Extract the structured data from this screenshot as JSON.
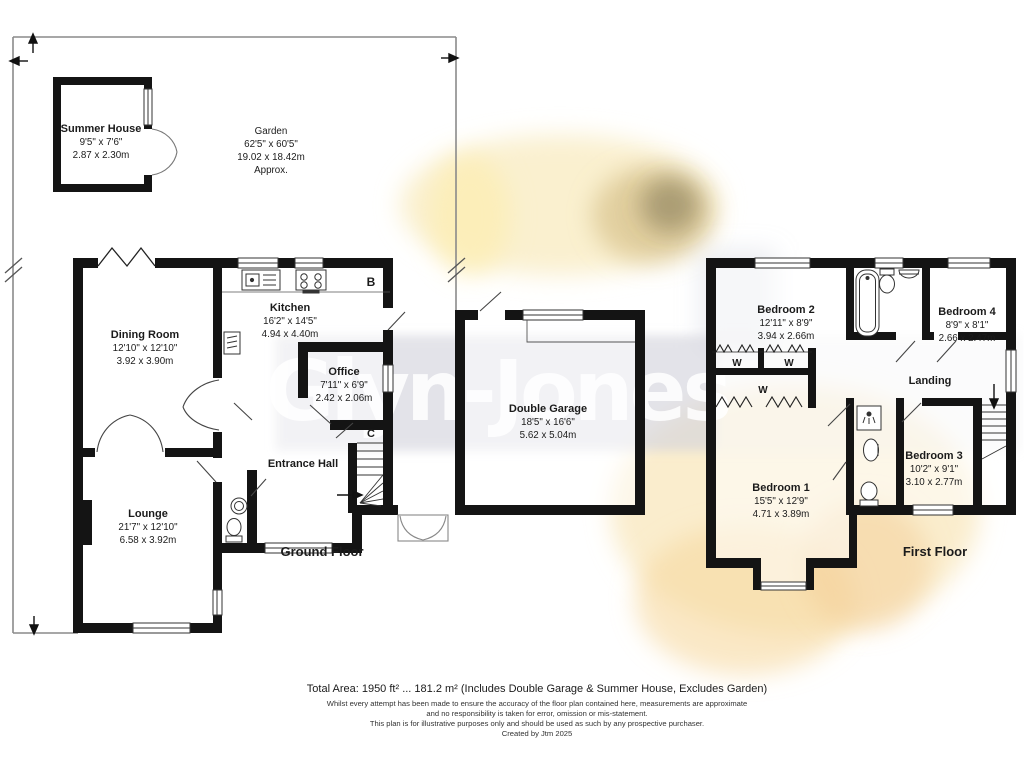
{
  "watermark": "Glyn-Jones",
  "garden": {
    "name": "Garden",
    "imperial": "62'5\" x 60'5\"",
    "metric": "19.02 x 18.42m",
    "approx": "Approx."
  },
  "rooms": {
    "summer_house": {
      "name": "Summer House",
      "imperial": "9'5\" x 7'6\"",
      "metric": "2.87 x 2.30m"
    },
    "dining_room": {
      "name": "Dining Room",
      "imperial": "12'10\" x 12'10\"",
      "metric": "3.92 x 3.90m"
    },
    "kitchen": {
      "name": "Kitchen",
      "imperial": "16'2\" x 14'5\"",
      "metric": "4.94 x 4.40m"
    },
    "office": {
      "name": "Office",
      "imperial": "7'11\" x 6'9\"",
      "metric": "2.42 x 2.06m"
    },
    "entrance_hall": {
      "name": "Entrance Hall"
    },
    "lounge": {
      "name": "Lounge",
      "imperial": "21'7\" x 12'10\"",
      "metric": "6.58 x 3.92m"
    },
    "double_garage": {
      "name": "Double Garage",
      "imperial": "18'5\" x 16'6\"",
      "metric": "5.62 x 5.04m"
    },
    "bedroom_1": {
      "name": "Bedroom 1",
      "imperial": "15'5\" x 12'9\"",
      "metric": "4.71 x 3.89m"
    },
    "bedroom_2": {
      "name": "Bedroom 2",
      "imperial": "12'11\" x 8'9\"",
      "metric": "3.94 x 2.66m"
    },
    "bedroom_3": {
      "name": "Bedroom 3",
      "imperial": "10'2\" x 9'1\"",
      "metric": "3.10 x 2.77m"
    },
    "bedroom_4": {
      "name": "Bedroom 4",
      "imperial": "8'9\" x 8'1\"",
      "metric": "2.66 x 2.47m"
    },
    "landing": {
      "name": "Landing"
    }
  },
  "floor_labels": {
    "ground": "Ground Floor",
    "first": "First Floor"
  },
  "markers": {
    "boiler": "B",
    "cupboard": "C",
    "wardrobe": "W"
  },
  "footer": {
    "total_area": "Total Area: 1950 ft² ... 181.2 m² (Includes Double Garage & Summer House, Excludes Garden)",
    "disclaimer_1": "Whilst every attempt has been made to ensure the accuracy of the floor plan contained here, measurements are approximate",
    "disclaimer_2": "and no responsibility is taken for error, omission or mis-statement.",
    "disclaimer_3": "This plan is for illustrative purposes only and should be used as such by any prospective purchaser.",
    "created_by": "Created by Jtm 2025"
  },
  "colors": {
    "wall": "#141414",
    "thin_line": "#3a3a3a",
    "garden_line": "#8a8a8a",
    "band": "#d8d9df"
  }
}
